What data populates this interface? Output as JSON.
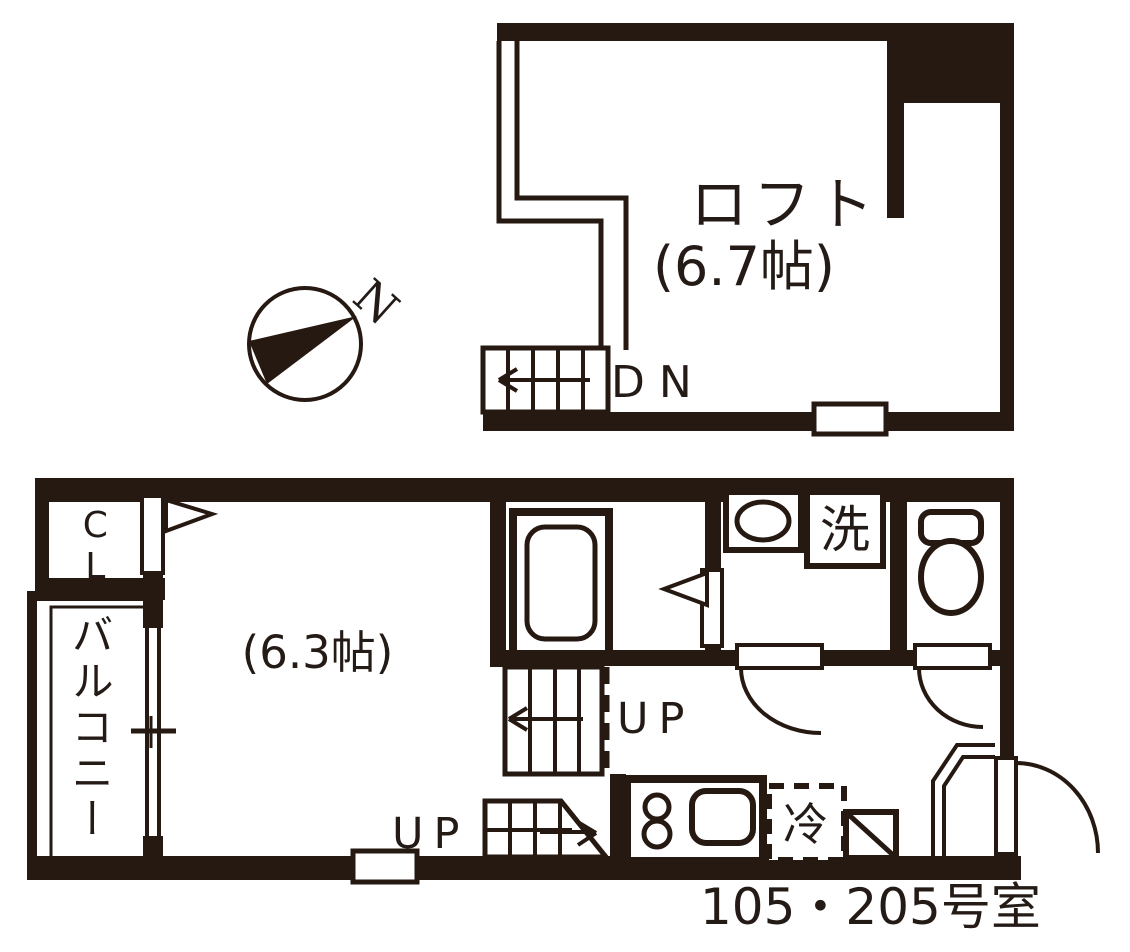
{
  "compass": {
    "north_label": "N"
  },
  "loft": {
    "room_label": "ロフト",
    "room_size": "(6.7帖)",
    "stairs_down_label": "DN"
  },
  "first_floor": {
    "room_size": "(6.3帖)",
    "closet_label": "CL",
    "balcony_label": "バルコニー",
    "washing_machine_label": "洗",
    "refrigerator_label": "冷",
    "stairs_up_label_upper": "UP",
    "stairs_up_label_lower": "UP",
    "unit_number_label": "105・205号室"
  },
  "colors": {
    "wall": "#261912",
    "background": "#ffffff",
    "text": "#241b16"
  }
}
